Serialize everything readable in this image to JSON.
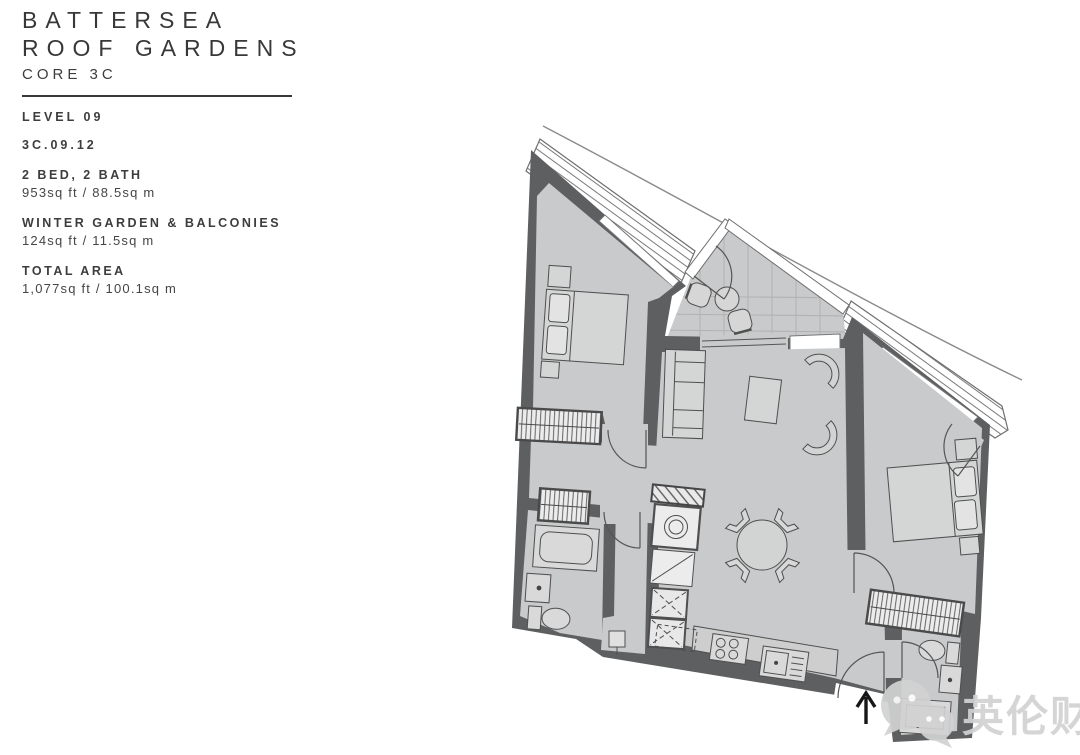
{
  "header": {
    "title_line1": "BATTERSEA",
    "title_line2": "ROOF GARDENS",
    "subtitle": "CORE 3C"
  },
  "unit": {
    "level": "LEVEL 09",
    "number": "3C.09.12",
    "rooms_label": "2 BED, 2 BATH",
    "rooms_area": "953sq ft / 88.5sq m",
    "winter_label": "WINTER GARDEN & BALCONIES",
    "winter_area": "124sq ft / 11.5sq m",
    "total_label": "TOTAL AREA",
    "total_area": "1,077sq ft / 100.1sq m"
  },
  "watermark": {
    "text": "英伦财富",
    "icon": "wechat-icon"
  },
  "floorplan": {
    "icons": [
      "entrance-arrow-icon",
      "wechat-icon"
    ],
    "colors": {
      "wall": "#5e5f60",
      "floor": "#c9cacb",
      "background": "#ffffff",
      "watermark": "#d2d2d2",
      "furniture_line": "#4f4f4f"
    }
  }
}
